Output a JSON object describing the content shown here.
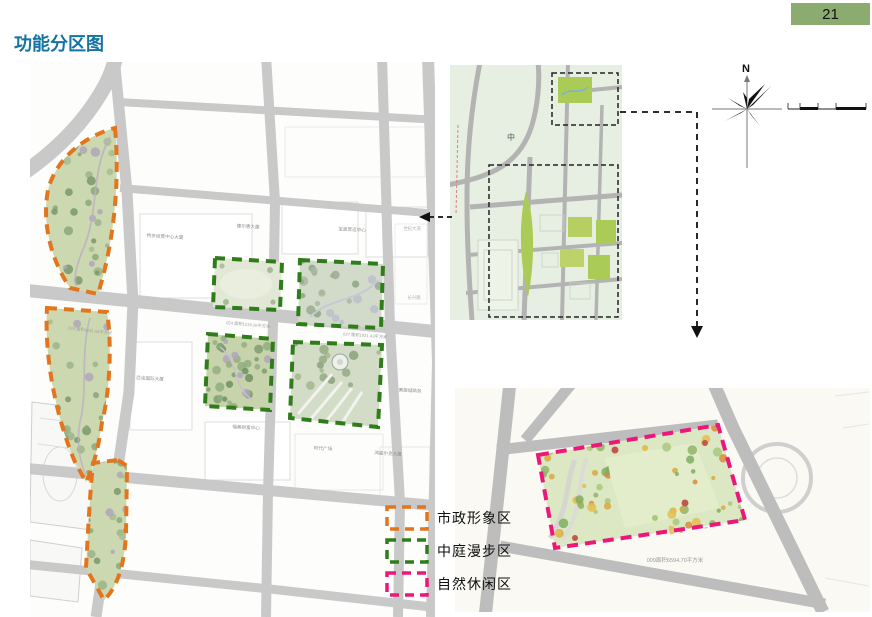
{
  "page": {
    "title": "功能分区图",
    "number": "21"
  },
  "legend": {
    "items": [
      {
        "label": "市政形象区",
        "color": "#e2751d"
      },
      {
        "label": "中庭漫步区",
        "color": "#2f7d1a"
      },
      {
        "label": "自然休闲区",
        "color": "#ec1879"
      }
    ]
  },
  "main_map": {
    "building_labels": [
      {
        "text": "特步运营中心大厦"
      },
      {
        "text": "德尔惠大厦"
      },
      {
        "text": "宝盖营运中心"
      },
      {
        "text": "匹克国际大厦"
      },
      {
        "text": "福美财富中心"
      },
      {
        "text": "时代广场"
      },
      {
        "text": "鸿星尔克大厦"
      },
      {
        "text": "美旗城商务"
      }
    ],
    "road_labels": [
      {
        "text": "世纪大道"
      },
      {
        "text": "长兴路"
      }
    ],
    "area_annotations": [
      {
        "text": "024 面积4241.64平方米"
      },
      {
        "text": "024 面积1219.26平方米"
      },
      {
        "text": "027 面积1931.43平方米"
      }
    ]
  },
  "overview_map": {
    "center_label": "中"
  },
  "detail_map": {
    "area_annotation": "009面积6594.70平方米"
  },
  "compass": {
    "north_label": "N"
  }
}
